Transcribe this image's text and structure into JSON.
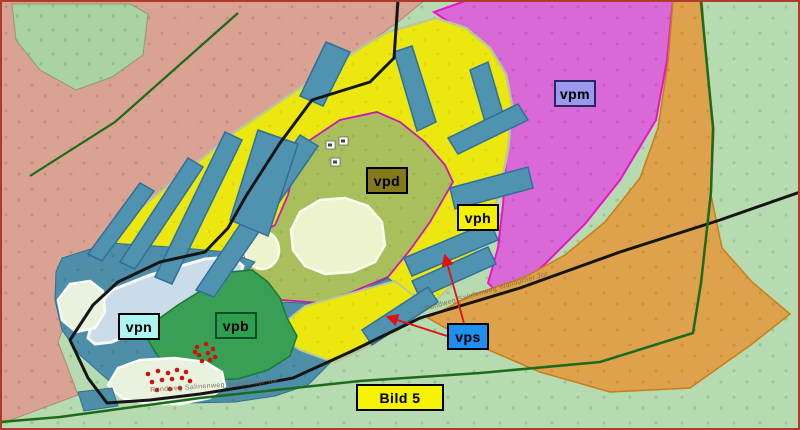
{
  "map": {
    "figure_label": "Bild 5",
    "labels": [
      {
        "id": "vpm",
        "text": "vpm",
        "fill": "#9a99ee",
        "zone_color": "#d969d6"
      },
      {
        "id": "vpd",
        "text": "vpd",
        "fill": "#847a1c",
        "zone_color": "#a9bf5b"
      },
      {
        "id": "vph",
        "text": "vph",
        "fill": "#f4f000",
        "zone_color": "#ece80f"
      },
      {
        "id": "vpn",
        "text": "vpn",
        "fill": "#adf4f2",
        "zone_color": "#cbdbe7"
      },
      {
        "id": "vpb",
        "text": "vpb",
        "fill": "#2e9e50",
        "zone_color": "#389f54"
      },
      {
        "id": "vps",
        "text": "vps",
        "fill": "#1e90f0",
        "zone_color": "#4f93b0"
      },
      {
        "id": "bild5",
        "text": "Bild 5",
        "fill": "#f6f300"
      }
    ],
    "road_labels": [
      {
        "text": "Rundweg Salinenweg Walldürner Tor"
      },
      {
        "text": "Rundweg Salinenweg Walldürner Tor"
      }
    ],
    "palette": {
      "frame_red": "#b03a2e",
      "meadow_salmon": "#d9a293",
      "grass_light_green": "#b7dbb0",
      "grove_green": "#a9d4a1",
      "magenta_zone": "#d969d6",
      "magenta_border": "#e815c8",
      "orange_zone": "#dfa24c",
      "yellow_zone": "#ece80f",
      "olive_zone": "#a9bf5b",
      "water_teal": "#4d8ea9",
      "plot_stripe_blue": "#4f93b0",
      "lake_pale_blue": "#cbdbe7",
      "vpb_green": "#389f54",
      "pond_cream": "#edf3cd",
      "boundary_black": "#151515",
      "ring_road_green": "#1b6b1b",
      "arrow_red": "#e01010",
      "tree_dot_red": "#cf1010"
    }
  }
}
